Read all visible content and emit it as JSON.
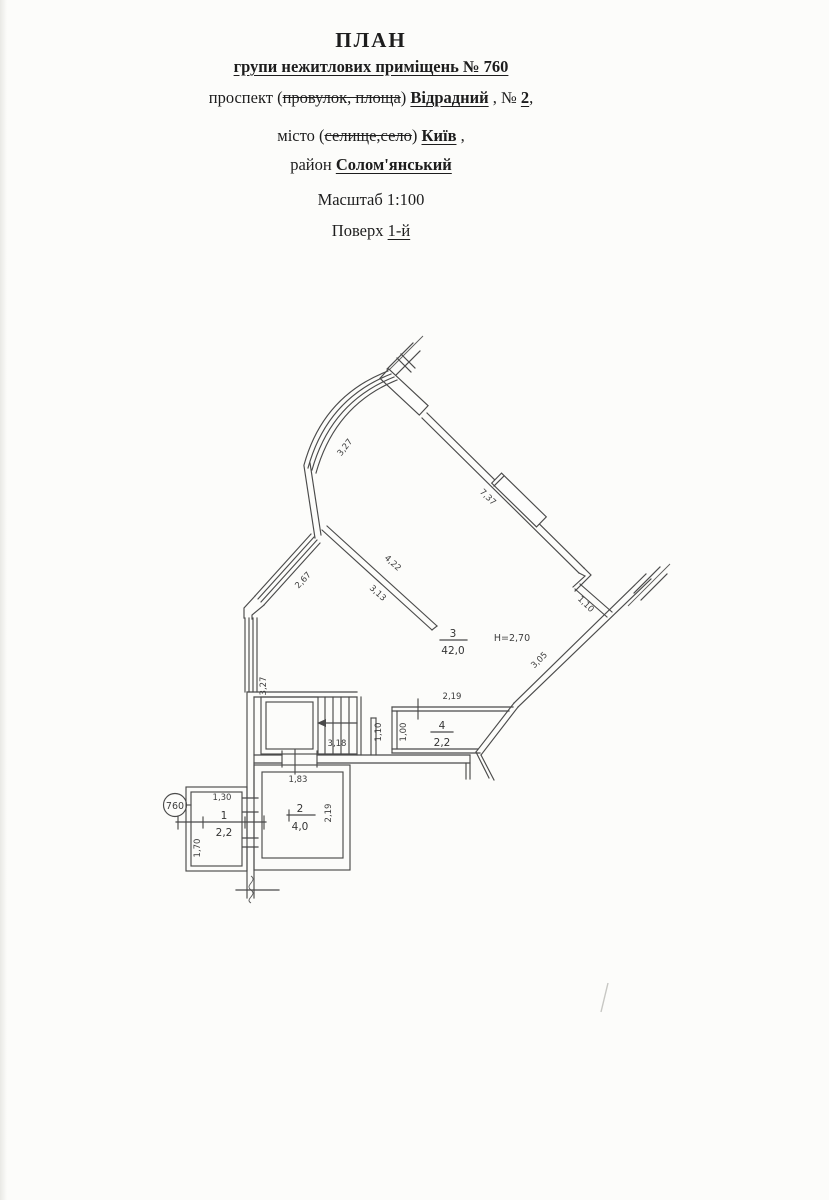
{
  "header": {
    "title": "ПЛАН",
    "subtitle": "групи нежитлових приміщень № 760",
    "address": {
      "pre": "проспект (",
      "struck": "провулок, площа",
      "mid": ") ",
      "value": "Відрадний",
      "mid2": " , № ",
      "num": "2",
      "post": ","
    },
    "city": {
      "pre": "місто (",
      "struck": "селище,село",
      "mid": ") ",
      "value": "Київ",
      "post": " ,"
    },
    "district": {
      "pre": "район ",
      "value": "Солом'янський"
    },
    "scale": "Масштаб 1:100",
    "floor": {
      "pre": "Поверх ",
      "value": "1-й"
    }
  },
  "plan": {
    "unit_badge": "760",
    "height_note": "Н=2,70",
    "rooms": [
      {
        "number": "1",
        "area": "2,2"
      },
      {
        "number": "2",
        "area": "4,0"
      },
      {
        "number": "3",
        "area": "42,0"
      },
      {
        "number": "4",
        "area": "2,2"
      }
    ],
    "dims": {
      "arc_window": "3,27",
      "top_wall": "7,37",
      "left_window": "2,67",
      "partition_top": "4,22",
      "partition_bottom": "3,13",
      "right_jog": "1,10",
      "right_wall": "3,05",
      "left_wall_vertical": "3,27",
      "stairs": "3,18",
      "room4_top": "2,19",
      "room4_left": "1,00",
      "wall_near_room4": "1,10",
      "opening": "1,83",
      "room2_right": "2,19",
      "room1_top": "1,30",
      "room1_left": "1,70"
    }
  }
}
